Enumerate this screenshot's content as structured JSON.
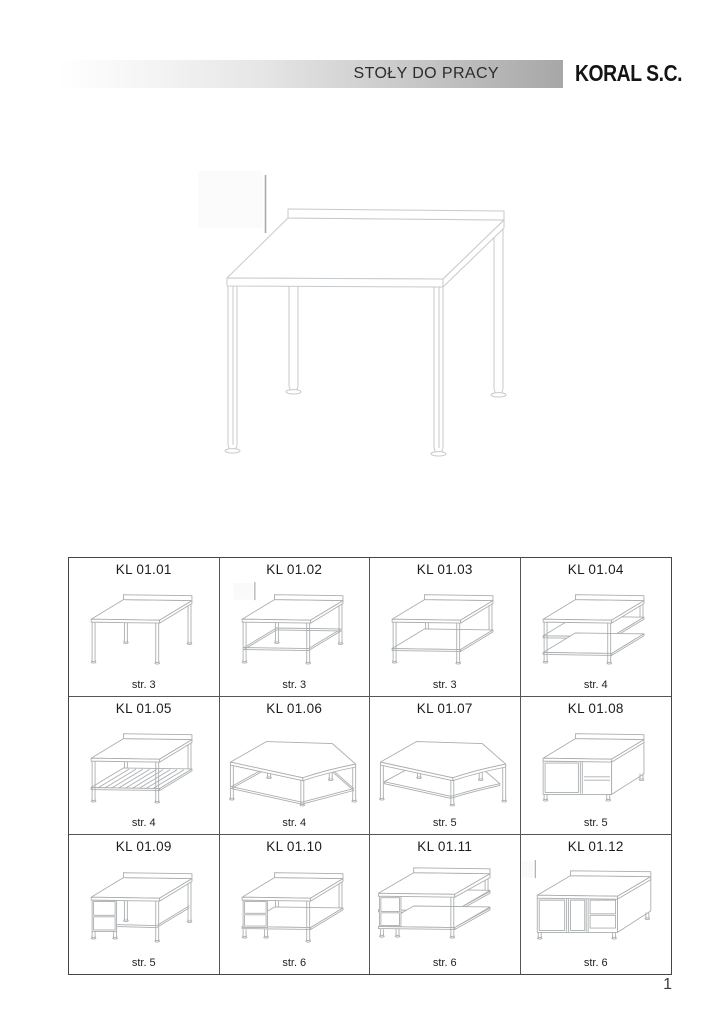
{
  "header": {
    "title": "STOŁY DO PRACY",
    "brand": "KORAL S.C."
  },
  "hero": {
    "description": "work table with rear upstand",
    "variant": "hero-plain-backsplash"
  },
  "catalog": {
    "items": [
      {
        "code": "KL 01.01",
        "page_ref": "str. 3",
        "variant": "plain"
      },
      {
        "code": "KL 01.02",
        "page_ref": "str. 3",
        "variant": "rails"
      },
      {
        "code": "KL 01.03",
        "page_ref": "str. 3",
        "variant": "shelf"
      },
      {
        "code": "KL 01.04",
        "page_ref": "str. 4",
        "variant": "two-shelves"
      },
      {
        "code": "KL 01.05",
        "page_ref": "str. 4",
        "variant": "grid-shelf"
      },
      {
        "code": "KL 01.06",
        "page_ref": "str. 4",
        "variant": "corner-rails"
      },
      {
        "code": "KL 01.07",
        "page_ref": "str. 5",
        "variant": "corner-shelf"
      },
      {
        "code": "KL 01.08",
        "page_ref": "str. 5",
        "variant": "cabinet"
      },
      {
        "code": "KL 01.09",
        "page_ref": "str. 5",
        "variant": "drawers-desk"
      },
      {
        "code": "KL 01.10",
        "page_ref": "str. 6",
        "variant": "drawers-shelf"
      },
      {
        "code": "KL 01.11",
        "page_ref": "str. 6",
        "variant": "shelves-drawers"
      },
      {
        "code": "KL 01.12",
        "page_ref": "str. 6",
        "variant": "cabinet-drawers"
      }
    ]
  },
  "footer": {
    "page_number": "1"
  },
  "colors": {
    "header_gradient_end": "#a7a7a7",
    "brand_text": "#141414",
    "grid_border": "#4c4c4c",
    "drawing_line_hero": "#c7cacc",
    "drawing_line_thumb": "#aaadaf",
    "scan_artifact_line": "#a9acae"
  }
}
